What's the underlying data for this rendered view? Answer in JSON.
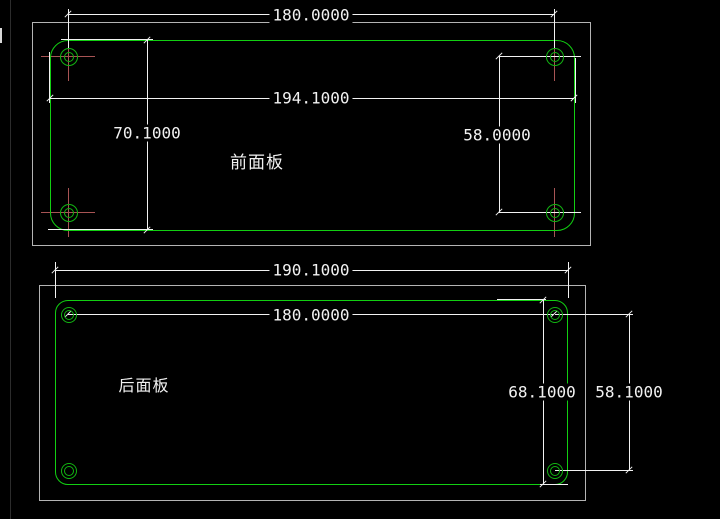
{
  "drawing": {
    "front_panel": {
      "label": "前面板",
      "dim_hole_spacing_width": "180.0000",
      "dim_overall_width": "194.1000",
      "dim_overall_height": "70.1000",
      "dim_hole_spacing_height": "58.0000"
    },
    "rear_panel": {
      "label": "后面板",
      "dim_overall_width": "190.1000",
      "dim_hole_spacing_width": "180.0000",
      "dim_overall_height": "68.1000",
      "dim_hole_spacing_height": "58.1000"
    },
    "colors": {
      "background": "#000000",
      "outline_green": "#12cf12",
      "dimension_white": "#f2f2f2",
      "frame_gray": "#b4b4b4",
      "center_mark_red": "#a85454"
    }
  }
}
